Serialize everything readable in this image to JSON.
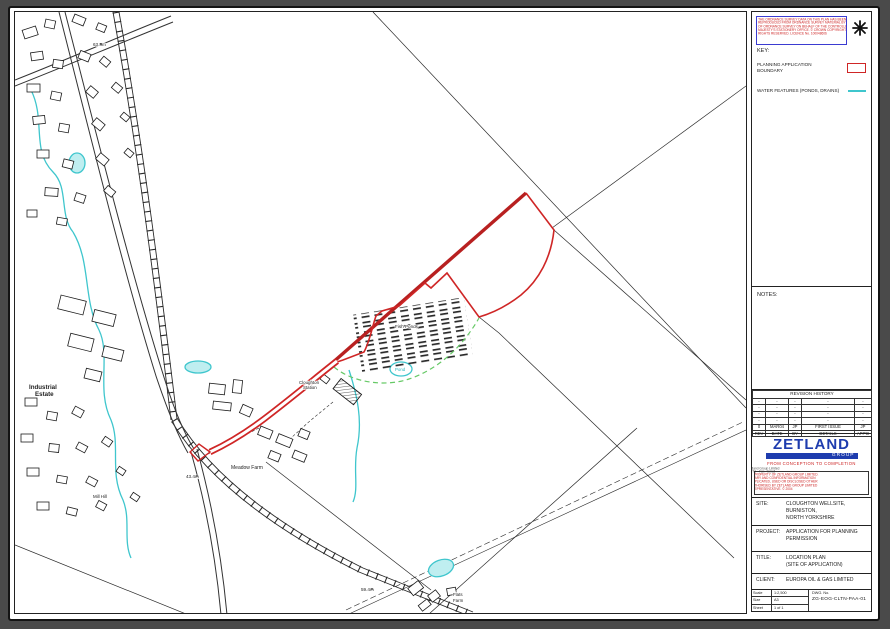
{
  "colors": {
    "boundary_red": "#cf2626",
    "boundary_red_dark": "#b82020",
    "water_cyan": "#3fc6cd",
    "vegetation_green": "#66c966",
    "brand_blue": "#1e3cae",
    "notice_red": "#cc2222"
  },
  "os_notice": {
    "lines": [
      "THE ORDNANCE SURVEY DATA ON THIS PLAN HAS BEEN",
      "REPRODUCED FROM ORDNANCE SURVEY MATERIAL BY PERMISSION",
      "OF ORDNANCE SURVEY ON BEHALF OF THE CONTROLLER OF HER",
      "MAJESTY'S STATIONERY OFFICE. © CROWN COPYRIGHT. ALL",
      "RIGHTS RESERVED. LICENCE No. 100048606"
    ]
  },
  "key": {
    "title": "KEY:",
    "boundary_label_line1": "PLANNING APPLICATION",
    "boundary_label_line2": "BOUNDARY",
    "water_label": "WATER FEATURES (PONDS, DRAINS)"
  },
  "notes_title": "NOTES:",
  "revision": {
    "title": "REVISION HISTORY",
    "rows": [
      [
        "-",
        "-",
        "-",
        "-",
        "-"
      ],
      [
        "-",
        "-",
        "-",
        "-",
        "-"
      ],
      [
        "-",
        "-",
        "-",
        "-",
        "-"
      ],
      [
        "-",
        "-",
        "-",
        "-",
        "-"
      ],
      [
        "0",
        "MAR04",
        "JP",
        "FIRST ISSUE",
        "JP"
      ]
    ],
    "footer": [
      "REV",
      "DATE",
      "BY",
      "DETAILS",
      "APP'D"
    ]
  },
  "brand": {
    "name": "ZETLAND",
    "group": "GROUP",
    "tagline": "FROM CONCEPTION TO COMPLETION",
    "contact_line1": "Zetland Group Limited",
    "contact_line2": "Tel · Fax · Email",
    "disclaimer_lines": [
      "THIS DOCUMENT IS THE PROPERTY OF ZETLAND GROUP LIMITED.",
      "IT CONTAINS PROPRIETARY AND CONFIDENTIAL INFORMATION",
      "WHICH MUST NOT BE DUPLICATED, USED OR DISCLOSED OTHER",
      "THAN AS EXPRESSLY AUTHORISED BY ZETLAND GROUP LIMITED",
      "OR ITS REPRESENTATIVE. © 2004"
    ]
  },
  "fields": {
    "site_label": "SITE:",
    "site_lines": [
      "CLOUGHTON WELLSITE,",
      "BURNISTON,",
      "NORTH YORKSHIRE"
    ],
    "project_label": "PROJECT:",
    "project_lines": [
      "APPLICATION FOR PLANNING",
      "PERMISSION"
    ],
    "title_label": "TITLE:",
    "title_lines": [
      "LOCATION PLAN",
      "(SITE OF APPLICATION)"
    ],
    "client_label": "CLIENT:",
    "client_lines": [
      "EUROPA OIL & GAS LIMITED"
    ]
  },
  "footer": {
    "scale_label": "Scale",
    "scale_value": "1:2,500",
    "size_label": "Size",
    "size_value": "A3",
    "sheet_label": "Sheet",
    "sheet_value": "1 of 1",
    "dwg_label": "DWG. No.",
    "dwg_value": "ZG-EOG-CLTN-PAA-01"
  },
  "map_labels": {
    "industrial_estate_line1": "Industrial",
    "industrial_estate_line2": "Estate",
    "meadow_farm": "Meadow Farm",
    "station_line1": "Cloughton",
    "station_line2": "Station",
    "fish_ponds": "Fish Ponds",
    "pond_1": "Pond",
    "flats_farm_line1": "Flats",
    "flats_farm_line2": "Farm",
    "spot_height_1": "63.8m",
    "spot_height_2": "43.4m",
    "spot_height_3": "59.4m",
    "mill_hill": "Mill Hill"
  }
}
